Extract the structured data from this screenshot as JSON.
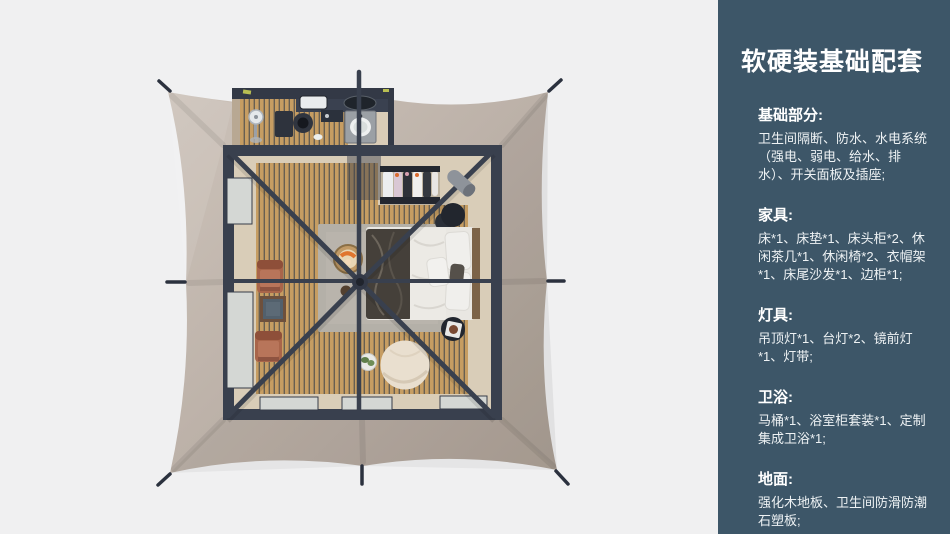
{
  "colors": {
    "bg": "#f0f0f1",
    "sidebar_bg": "#3d5668",
    "canvas_light": "#cdc3ba",
    "canvas_mid": "#bcb1a8",
    "canvas_dark": "#aca095",
    "frame": "#39404e",
    "wood_plank": "#c69d62",
    "wood_gap": "#675f52",
    "floor_beige": "#d9cdb8",
    "rug": "#b4b0a8",
    "bed_white": "#e9e7e2",
    "throw_dark": "#45403a",
    "chair_terracotta": "#a9654a",
    "pouf_cream": "#e9dfcf",
    "accent_yellow": "#b9bf52"
  },
  "sidebar": {
    "title": "软硬装基础配套",
    "sections": [
      {
        "label": "基础部分:",
        "body": "卫生间隔断、防水、水电系统（强电、弱电、给水、排水）、开关面板及插座;"
      },
      {
        "label": "家具:",
        "body": "床*1、床垫*1、床头柜*2、休闲茶几*1、休闲椅*2、衣帽架*1、床尾沙发*1、边柜*1;"
      },
      {
        "label": "灯具:",
        "body": "吊顶灯*1、台灯*2、镜前灯*1、灯带;"
      },
      {
        "label": "卫浴:",
        "body": "马桶*1、浴室柜套装*1、定制集成卫浴*1;"
      },
      {
        "label": "地面:",
        "body": "强化木地板、卫生间防滑防潮石塑板;"
      }
    ]
  }
}
